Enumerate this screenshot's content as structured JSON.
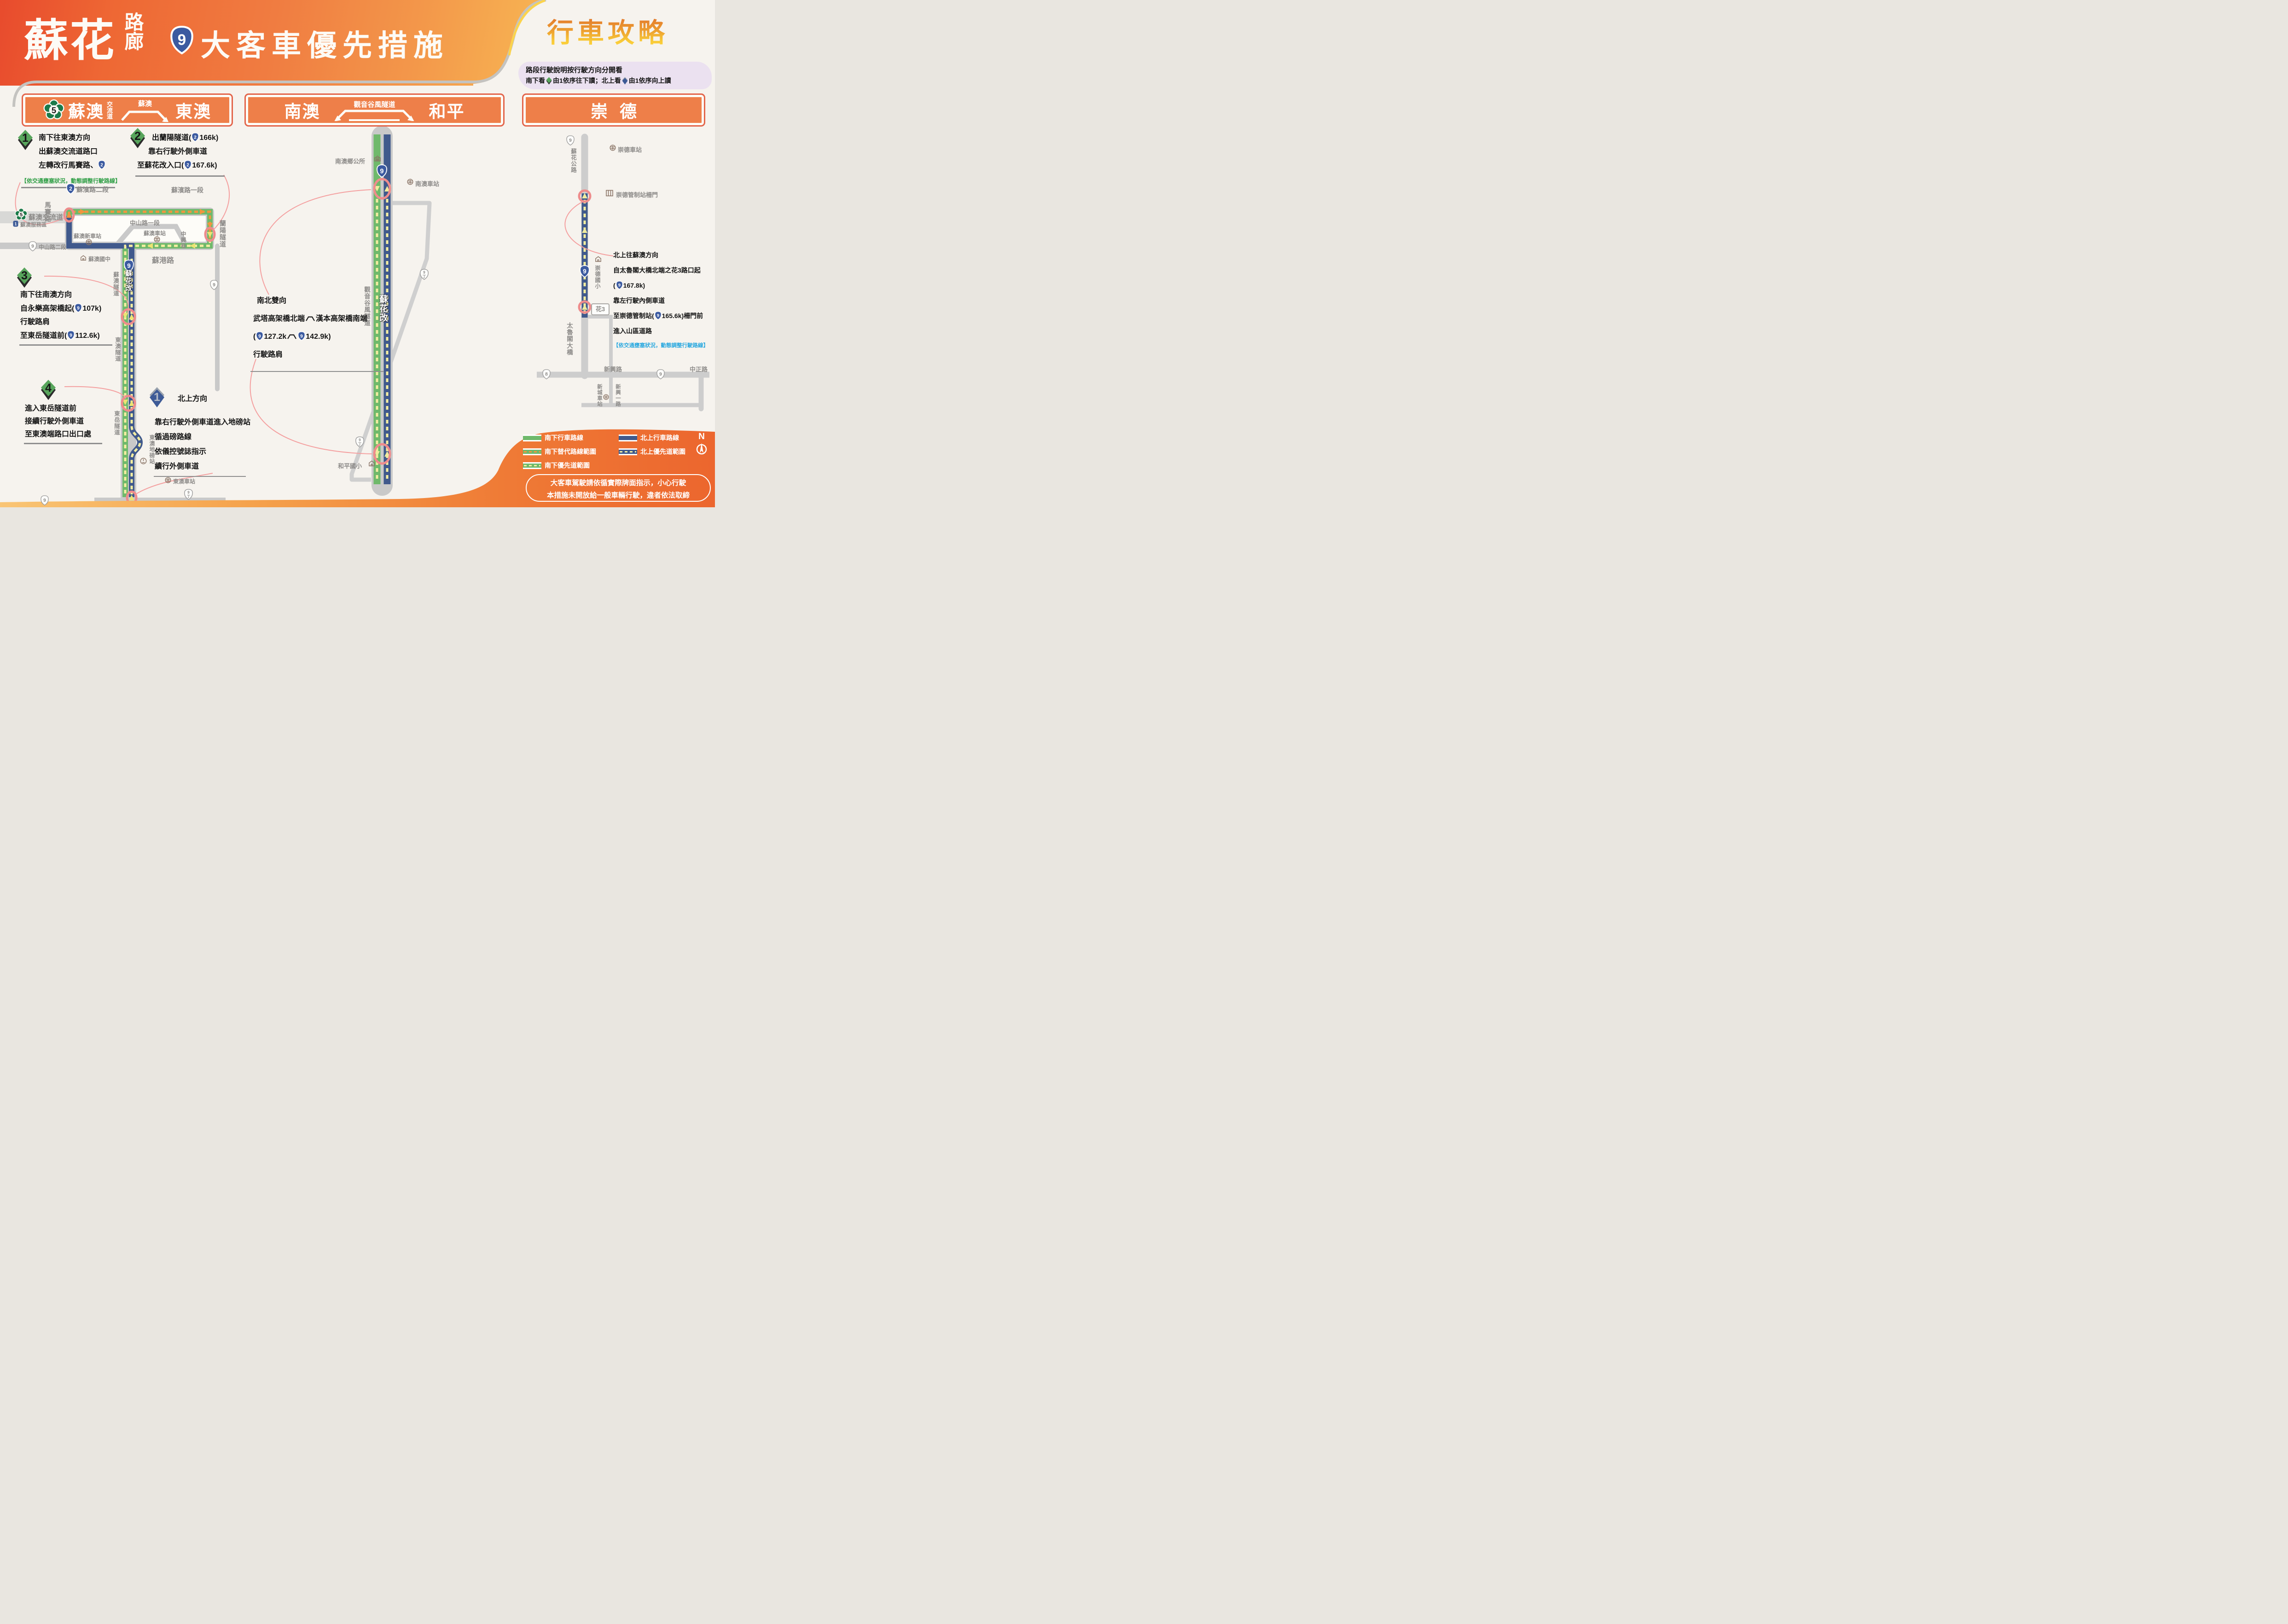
{
  "header": {
    "brand_big": "蘇花",
    "brand_small": "路廊",
    "title": "大客車優先措施",
    "guide": "行車攻略",
    "note1": "路段行駛說明按行駛方向分開看",
    "note2a": "南下看",
    "note2b": "由1依序往下讀；北上看",
    "note2c": "由1依序向上讀"
  },
  "sh": {
    "two": "2",
    "five": "5",
    "eight": "8",
    "nine": "9",
    "dtop": "9",
    "dbot": "丁",
    "svc": "1"
  },
  "p1": {
    "plate": {
      "name": "蘇澳",
      "name2": "交流道",
      "via": "蘇澳",
      "to": "東澳"
    },
    "s1": {
      "n": "1",
      "l1": "南下往東澳方向",
      "l2": "出蘇澳交流道路口",
      "l3": "左轉改行馬賽路、",
      "note": "【依交通壅塞狀況，動態調整行駛路線】"
    },
    "s2": {
      "n": "2",
      "l1a": "出蘭陽隧道(",
      "l1b": "166k)",
      "l2": "靠右行駛外側車道",
      "l3a": "至蘇花改入口(",
      "l3b": "167.6k)"
    },
    "s3": {
      "n": "3",
      "l1": "南下往南澳方向",
      "l2a": "自永樂高架橋起(",
      "l2b": "107k)",
      "l3": "行駛路肩",
      "l4a": "至東岳隧道前(",
      "l4b": "112.6k)"
    },
    "s4": {
      "n": "4",
      "l1": "進入東岳隧道前",
      "l2": "接續行駛外側車道",
      "l3": "至東澳端路口出口處"
    },
    "n1": {
      "n": "1",
      "t": "北上方向",
      "l1": "靠右行駛外側車道進入地磅站",
      "l2": "循過磅路線",
      "l3": "依儀控號誌指示",
      "l4": "續行外側車道"
    },
    "map": {
      "subin2": "蘇濱路二段",
      "subin1": "蘇濱路一段",
      "masai": "馬賽路",
      "lanyang": "蘭陽隧道",
      "zs1": "中山路一段",
      "zs2": "中山路二段",
      "zhongxing": "中興巷",
      "ic5": "蘇澳交流道",
      "service": "蘇澳服務區",
      "st_new": "蘇澳新車站",
      "st_suao": "蘇澳車站",
      "school": "蘇澳國中",
      "sugang": "蘇港路",
      "t_suao": "蘇澳隧道",
      "gai": "蘇花改",
      "t_dongao": "東澳隧道",
      "t_dongyue": "東岳隧道",
      "weigh": "東澳地磅站",
      "st_dongao": "東澳車站"
    }
  },
  "p2": {
    "plate": {
      "from": "南澳",
      "tunnel": "觀音谷風隧道",
      "to": "和平"
    },
    "txt": {
      "l1": "南北雙向",
      "l2a": "武塔高架橋北端",
      "l2b": "漢本高架橋南端",
      "l3a": "(",
      "l3b": "127.2k",
      "l3c": "142.9k)",
      "l4": "行駛路肩"
    },
    "map": {
      "hall": "南澳鄉公所",
      "st": "南澳車站",
      "tunnel": "觀音谷風隧道",
      "gai": "蘇花改",
      "school": "和平國小"
    }
  },
  "p3": {
    "plate": {
      "name": "崇德"
    },
    "txt": {
      "l1": "北上往蘇澳方向",
      "l2": "自太魯閣大橋北端之花3路口起",
      "l3a": "(",
      "l3b": "167.8k)",
      "l4": "靠左行駛內側車道",
      "l5a": "至崇德管制站(",
      "l5b": "165.6k)柵門前",
      "l6": "進入山區道路",
      "note": "【依交通壅塞狀況，動態調整行駛路線】"
    },
    "map": {
      "hwy": "蘇花公路",
      "st": "崇德車站",
      "gate": "崇德管制站柵門",
      "school": "崇德國小",
      "hua3": "花3",
      "bridge": "太魯閣大橋",
      "xinxing": "新興路",
      "zhongzheng": "中正路",
      "xincheng": "新城車站",
      "xinxing1": "新興一路"
    }
  },
  "legend": {
    "s1": "南下行車路線",
    "s2": "南下替代路線範圍",
    "s3": "南下優先道範圍",
    "n1": "北上行車路線",
    "n2": "北上優先道範圍",
    "compass": "N"
  },
  "warn": {
    "l1": "大客車駕駛請依循實際牌面指示，小心行駛",
    "l2": "本措施未開放給一般車輛行駛，違者依法取締"
  }
}
